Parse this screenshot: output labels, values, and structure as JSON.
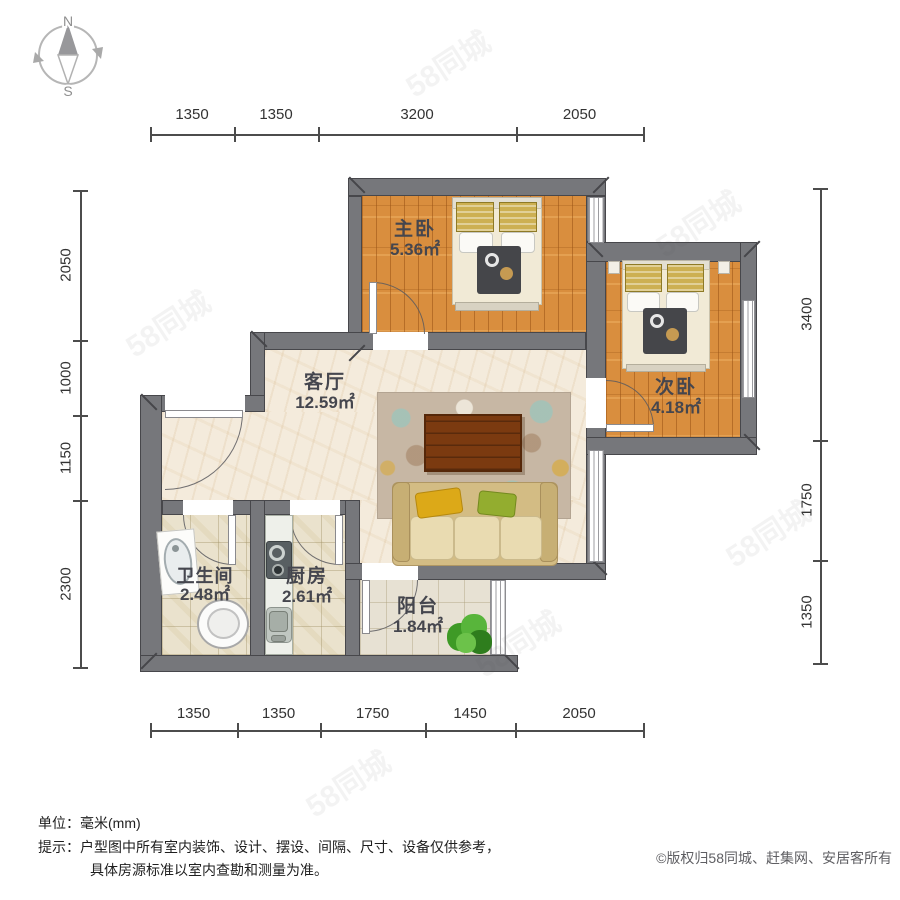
{
  "compass": {
    "north": "N",
    "south": "S"
  },
  "rooms": {
    "master_bedroom": {
      "name": "主卧",
      "area": "5.36㎡"
    },
    "second_bedroom": {
      "name": "次卧",
      "area": "4.18㎡"
    },
    "living_room": {
      "name": "客厅",
      "area": "12.59㎡"
    },
    "bathroom": {
      "name": "卫生间",
      "area": "2.48㎡"
    },
    "kitchen": {
      "name": "厨房",
      "area": "2.61㎡"
    },
    "balcony": {
      "name": "阳台",
      "area": "1.84㎡"
    }
  },
  "dimensions_mm": {
    "top": [
      "1350",
      "1350",
      "3200",
      "2050"
    ],
    "bottom": [
      "1350",
      "1350",
      "1750",
      "1450",
      "2050"
    ],
    "left": [
      "2050",
      "1000",
      "1150",
      "2300"
    ],
    "right": [
      "3400",
      "1750",
      "1350"
    ]
  },
  "footer": {
    "unit_label": "单位：",
    "unit_value": "毫米(mm)",
    "tip_label": "提示：",
    "tip_line1": "户型图中所有室内装饰、设计、摆设、间隔、尺寸、设备仅供参考，",
    "tip_line2": "具体房源标准以室内查勘和测量为准。",
    "copyright": "©版权归58同城、赶集网、安居客所有"
  },
  "watermark_text": "58同城",
  "colors": {
    "wall": "#76777b",
    "wood_floor": "#d98e3e",
    "marble_floor": "#f4ebdc",
    "tile_floor": "#eae2cd",
    "sofa": "#d3bc84",
    "rug_base": "#c7b7a4",
    "table": "#7b3a10",
    "pillow_yellow": "#dca918",
    "pillow_green": "#93ad2f",
    "plant_green": "#3e9a26"
  }
}
